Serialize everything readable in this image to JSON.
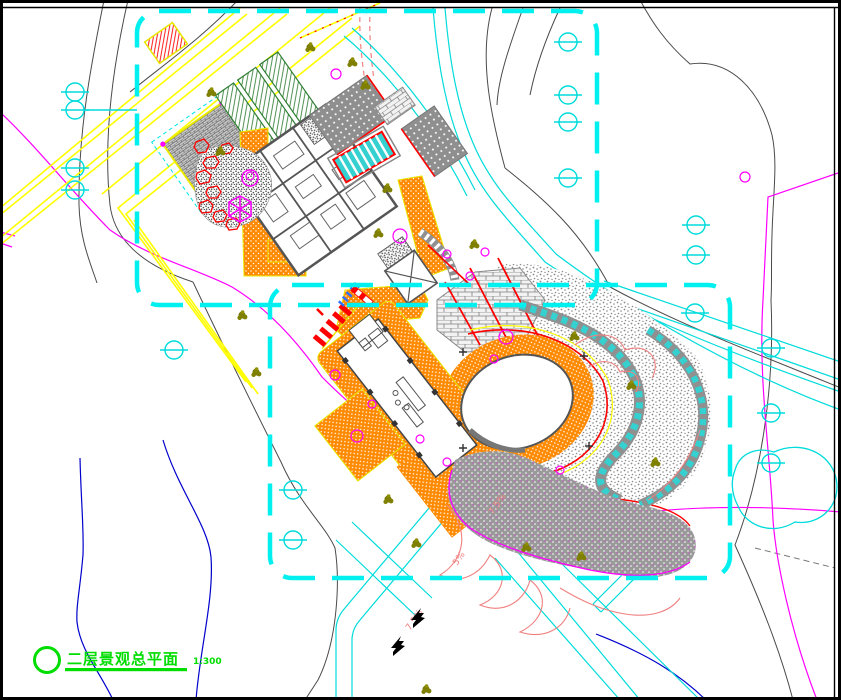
{
  "drawing": {
    "type": "landscape-site-plan",
    "discipline": "landscape architecture CAD drawing"
  },
  "title_block": {
    "title": "二层景观总平面",
    "scale": "1:300"
  },
  "slope_labels": [
    {
      "text": "7.5%"
    },
    {
      "text": "5%"
    },
    {
      "text": "7.5%"
    }
  ],
  "symbols": {
    "survey_marker": "circle-with-horizontal-line",
    "tree": "olive-cluster-blob",
    "shrub": "magenta-outline-circle",
    "pavilion": "magenta-hexagon",
    "boundary": "cyan-dashed-rounded-rectangle"
  },
  "colors": {
    "boundary_cyan": "#00EFEF",
    "road_cyan": "#00DBDB",
    "contour_gray": "#4A4A4A",
    "contour_magenta": "#FF00FF",
    "contour_blue": "#0000CC",
    "contour_salmon": "#F08080",
    "terrace_yellow": "#FFFF00",
    "paving_orange": "#FF8A00",
    "accent_red": "#FF0000",
    "tree_olive": "#808000",
    "title_green": "#00DD00",
    "wall_gray": "#555555"
  }
}
